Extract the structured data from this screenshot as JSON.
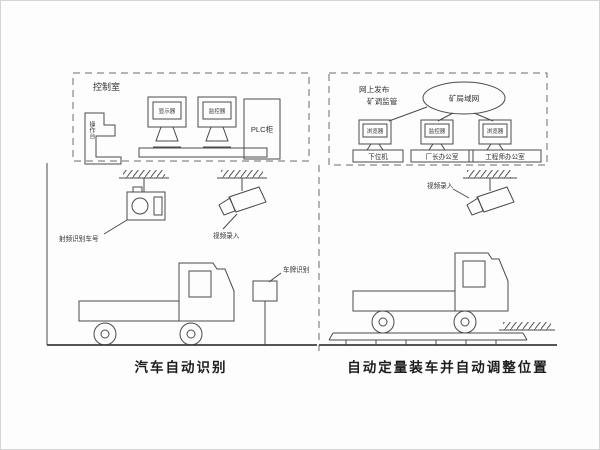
{
  "diagram": {
    "control_room": {
      "title": "控制室",
      "console_label": "操作台",
      "monitor1_label": "显示器",
      "monitor2_label": "监控器",
      "plc_label": "PLC柜"
    },
    "network": {
      "note_line1": "网上发布",
      "note_line2": "矿调监管",
      "cloud_label": "矿局域网",
      "pcs": [
        {
          "screen": "浏览器",
          "caption": "下位机"
        },
        {
          "screen": "监控器",
          "caption": "厂长办公室"
        },
        {
          "screen": "浏览器",
          "caption": "工程师办公室"
        }
      ]
    },
    "identification": {
      "rfid_label": "射频识别车号",
      "camera_label": "视频录入",
      "plate_label": "车牌识别",
      "caption": "汽车自动识别"
    },
    "loading": {
      "camera_label": "视频录入",
      "caption": "自动定量装车并自动调整位置"
    }
  },
  "colors": {
    "line": "#4a4a4a",
    "text": "#333333",
    "background": "#fdfdfd"
  }
}
